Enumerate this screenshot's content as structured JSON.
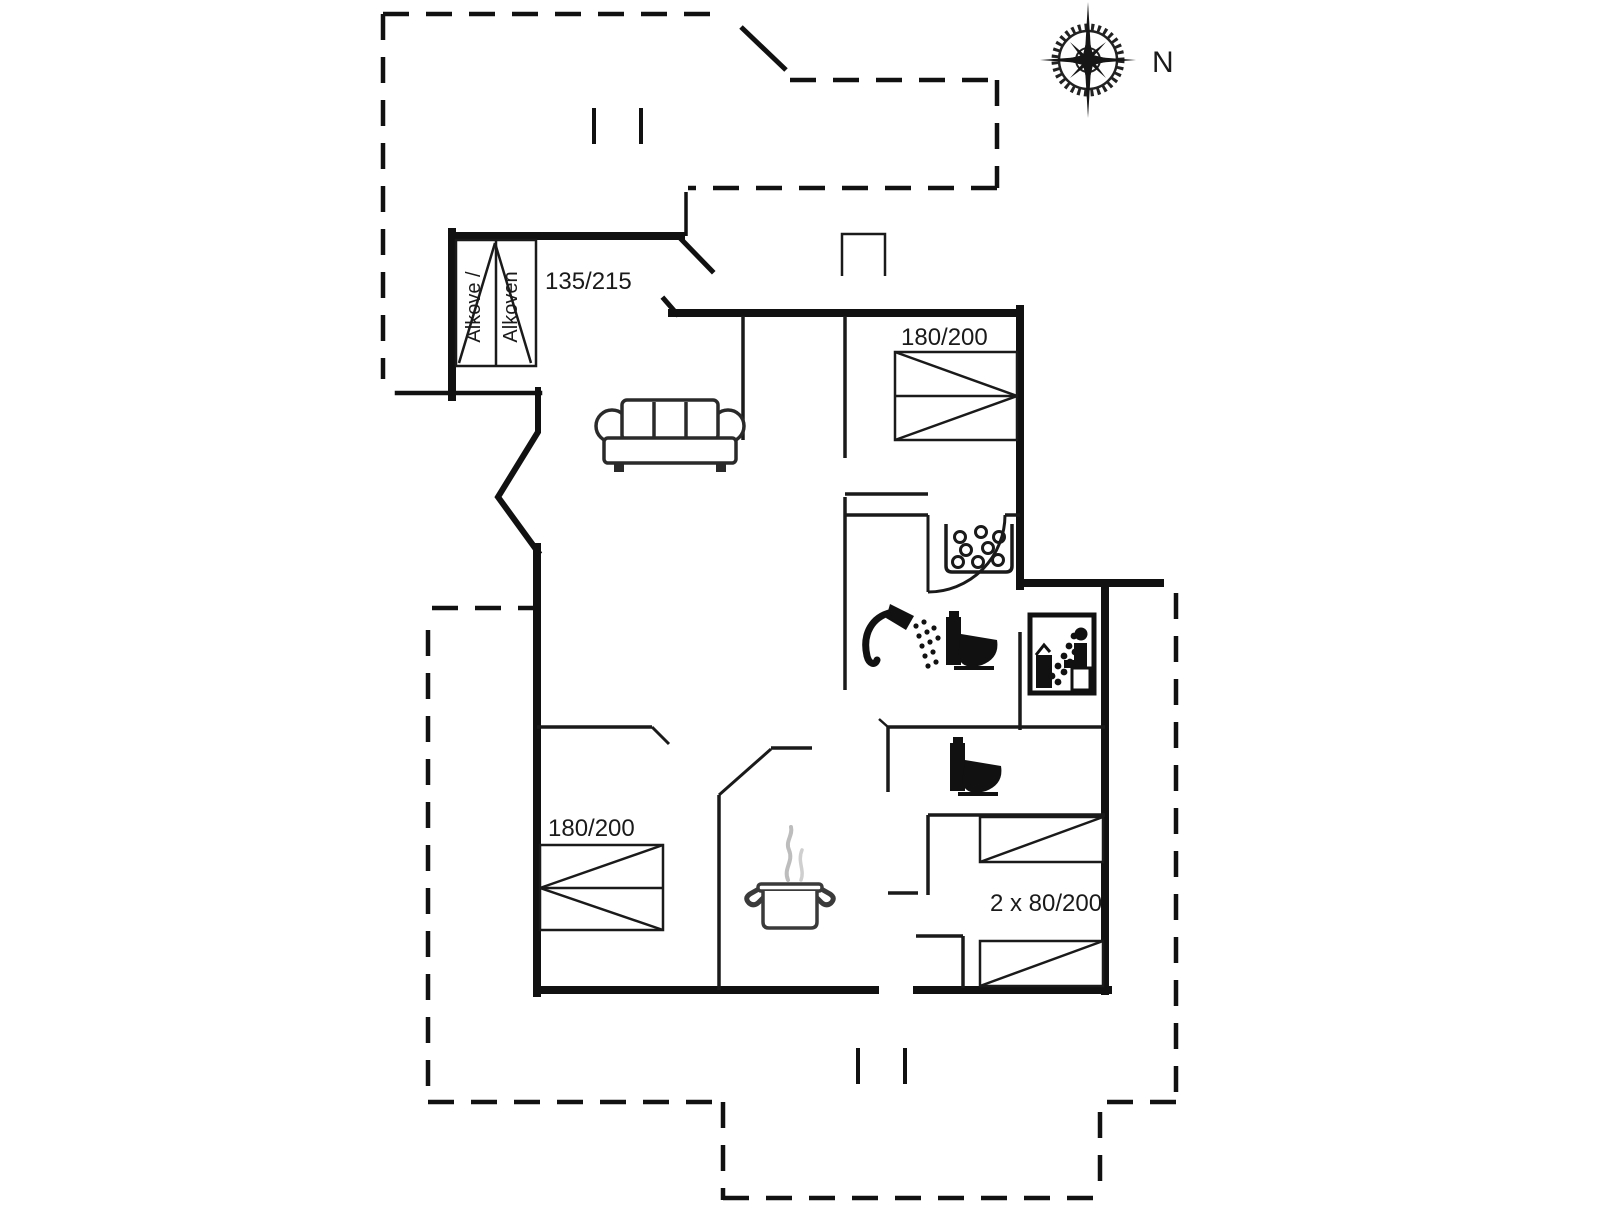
{
  "plan": {
    "type": "vacation-house-floor-plan",
    "compass": {
      "label": "N"
    },
    "labels": {
      "alkove_line1": "Alkove /",
      "alkove_line2": "Alkoven",
      "alkove_size": "135/215",
      "bed_top_right": "180/200",
      "bed_bottom_left": "180/200",
      "bunk_beds": "2 x 80/200"
    },
    "symbols": [
      "compass-rose",
      "alkove-bed",
      "double-bed",
      "double-bed",
      "two-single-beds",
      "sofa",
      "hob",
      "shower",
      "toilet",
      "toilet",
      "sauna",
      "cooking-pot"
    ],
    "colors": {
      "wall": "#111111",
      "thin_wall": "#1a1a1a",
      "background": "#ffffff",
      "steam": "#bbbbbb"
    }
  }
}
